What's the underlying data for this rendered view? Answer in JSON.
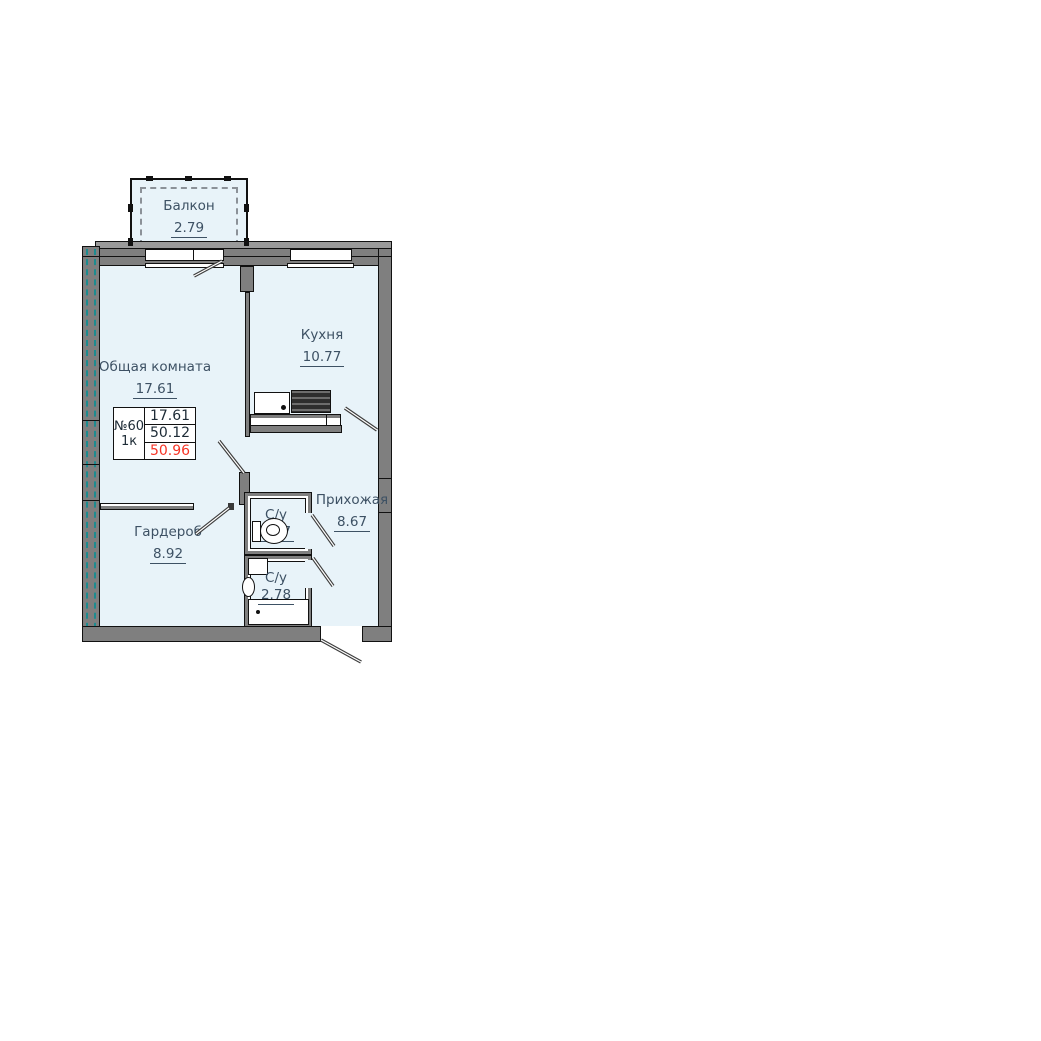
{
  "colors": {
    "room_fill": "#e8f3f9",
    "wall": "#7f7f7f",
    "wall_edge": "#111111",
    "insulation_teal": "#1d8b8f",
    "label_text": "#3d5164",
    "table_text": "#1d2b36",
    "total_area_red": "#f63526"
  },
  "apartment_card": {
    "number": "№60",
    "rooms_count": "1к",
    "living_area": "17.61",
    "usable_area": "50.12",
    "total_area": "50.96"
  },
  "rooms": {
    "balcony": {
      "label": "Балкон",
      "area": "2.79"
    },
    "living": {
      "label": "Общая комната",
      "area": "17.61"
    },
    "kitchen": {
      "label": "Кухня",
      "area": "10.77"
    },
    "hallway": {
      "label": "Прихожая",
      "area": "8.67"
    },
    "wardrobe": {
      "label": "Гардероб",
      "area": "8.92"
    },
    "bathroom_small": {
      "label": "С/у",
      "area": "1.37"
    },
    "bathroom_large": {
      "label": "С/у",
      "area": "2.78"
    }
  },
  "fixtures": [
    "kitchen-sink",
    "stove",
    "toilet",
    "washing-machine",
    "hand-sink",
    "bathtub"
  ]
}
